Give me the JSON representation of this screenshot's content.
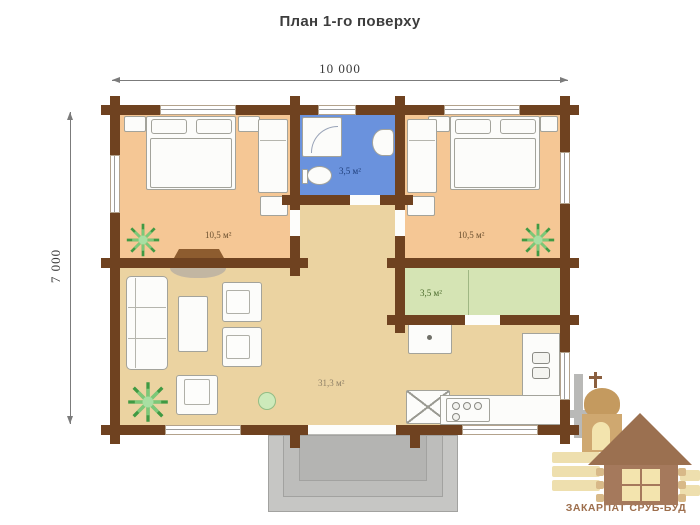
{
  "title": "План 1-го поверху",
  "dimensions": {
    "width_label": "10 000",
    "height_label": "7 000"
  },
  "rooms": {
    "bedroom_left": {
      "area_label": "10,5 м²"
    },
    "bathroom": {
      "area_label": "3,5 м²"
    },
    "bedroom_right": {
      "area_label": "10,5 м²"
    },
    "pantry": {
      "area_label": "3,5 м²"
    },
    "living_room": {
      "area_label": "31,3 м²"
    }
  },
  "logo": {
    "brand": "ЗАКАРПАТ СРУБ-БУД"
  },
  "colors": {
    "wall": "#6f4220",
    "bedroom_floor": "#f5c795",
    "bathroom_floor": "#6a92dd",
    "pantry_floor": "#d5e4b4",
    "living_floor": "#ebd3a1",
    "porch": "#c6c6c4",
    "brand_text": "#9d6e4c"
  }
}
